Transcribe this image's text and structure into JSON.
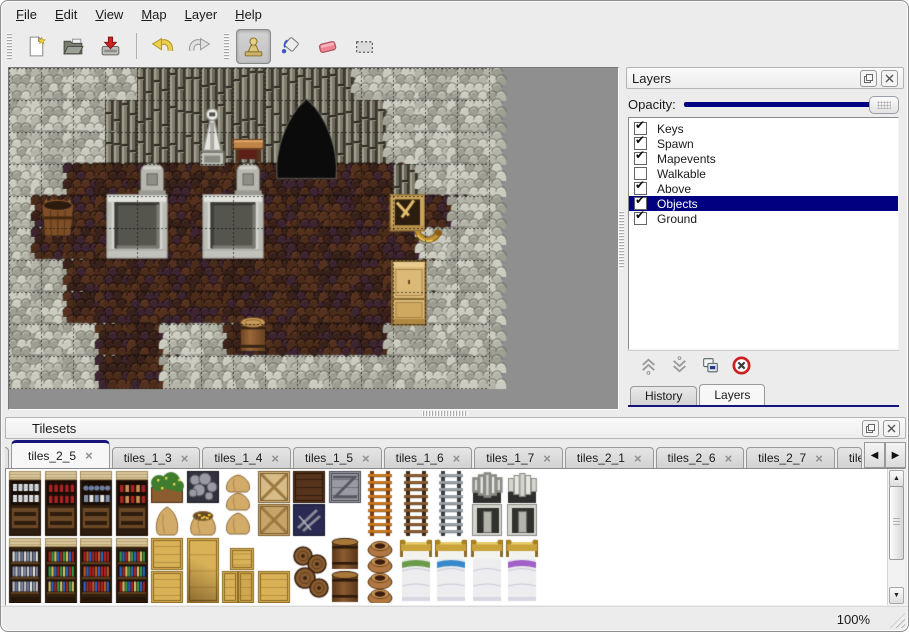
{
  "colors": {
    "accent": "#000080",
    "selection": "#000080",
    "tab_line": "#14147a"
  },
  "menu": {
    "items": [
      {
        "label": "File"
      },
      {
        "label": "Edit"
      },
      {
        "label": "View"
      },
      {
        "label": "Map"
      },
      {
        "label": "Layer"
      },
      {
        "label": "Help"
      }
    ]
  },
  "toolbar": {
    "buttons": [
      {
        "type": "handle"
      },
      {
        "type": "button",
        "name": "new-map-button",
        "icon": "new-file-icon"
      },
      {
        "type": "button",
        "name": "open-button",
        "icon": "open-folder-icon"
      },
      {
        "type": "button",
        "name": "save-button",
        "icon": "save-icon"
      },
      {
        "type": "separator"
      },
      {
        "type": "button",
        "name": "undo-button",
        "icon": "undo-icon"
      },
      {
        "type": "button",
        "name": "redo-button",
        "icon": "redo-icon"
      },
      {
        "type": "handle"
      },
      {
        "type": "button",
        "name": "stamp-tool-button",
        "icon": "stamp-icon",
        "active": true
      },
      {
        "type": "button",
        "name": "fill-tool-button",
        "icon": "fill-icon"
      },
      {
        "type": "button",
        "name": "eraser-tool-button",
        "icon": "eraser-icon"
      },
      {
        "type": "button",
        "name": "select-tool-button",
        "icon": "select-icon"
      }
    ]
  },
  "layers_panel": {
    "title": "Layers",
    "float_glyph": "float-icon",
    "close_glyph": "close-icon",
    "opacity_label": "Opacity:",
    "opacity_percent": 100,
    "check_glyph": "✔",
    "layers": [
      {
        "name": "Keys",
        "checked": true,
        "selected": false
      },
      {
        "name": "Spawn",
        "checked": true,
        "selected": false
      },
      {
        "name": "Mapevents",
        "checked": true,
        "selected": false
      },
      {
        "name": "Walkable",
        "checked": false,
        "selected": false
      },
      {
        "name": "Above",
        "checked": true,
        "selected": false
      },
      {
        "name": "Objects",
        "checked": true,
        "selected": true
      },
      {
        "name": "Ground",
        "checked": true,
        "selected": false
      }
    ],
    "buttons": [
      {
        "name": "raise-layer-button",
        "icon": "chevrons-up-icon"
      },
      {
        "name": "lower-layer-button",
        "icon": "chevrons-down-icon"
      },
      {
        "name": "duplicate-layer-button",
        "icon": "copy-icon"
      },
      {
        "name": "delete-layer-button",
        "icon": "delete-icon"
      }
    ],
    "tabs": [
      {
        "label": "History",
        "active": false
      },
      {
        "label": "Layers",
        "active": true
      }
    ]
  },
  "tilesets_panel": {
    "title": "Tilesets",
    "tabs": [
      {
        "label": "tiles_2_5",
        "active": true
      },
      {
        "label": "tiles_1_3"
      },
      {
        "label": "tiles_1_4"
      },
      {
        "label": "tiles_1_5"
      },
      {
        "label": "tiles_1_6"
      },
      {
        "label": "tiles_1_7"
      },
      {
        "label": "tiles_2_1"
      },
      {
        "label": "tiles_2_6"
      },
      {
        "label": "tiles_2_7"
      },
      {
        "label": "tiles_",
        "truncated": true
      }
    ],
    "tab_close_glyph": "×",
    "scroll_left_glyph": "◀",
    "scroll_right_glyph": "▶",
    "scroll_up_glyph": "▲",
    "scroll_down_glyph": "▼"
  },
  "statusbar": {
    "zoom": "100%"
  },
  "map_data": {
    "tile_size": 32,
    "legend": {
      "W": "light-rock-wall",
      "D": "dark-rib-wall",
      "F": "dirt-floor"
    },
    "grid": [
      "WWWWDDDDDDDWWWW",
      "WWWDDDDDDDDDWWW",
      "WWWDDDDDDDDDWWW",
      "WWFFFFFFFFFFDWW",
      "WFFFFFFFFFFFFFW",
      "WFFFFFFFFFFFFWW",
      "WWFFFFFFFFFFFWW",
      "WWFFFFFFFFFFFWW",
      "WWWFFWWFFFFFWWW",
      "WWWFFWWWWWWWWWW"
    ],
    "objects": [
      {
        "type": "cave-entrance",
        "x": 8.15,
        "y": 0.9,
        "w": 2.3,
        "h": 2.55
      },
      {
        "type": "statue",
        "x": 5.85,
        "y": 1.2,
        "w": 1.0,
        "h": 1.85
      },
      {
        "type": "table",
        "x": 6.95,
        "y": 2.1,
        "w": 1.05,
        "h": 0.9
      },
      {
        "type": "gravestone",
        "x": 4.05,
        "y": 2.95,
        "w": 0.85,
        "h": 1.0
      },
      {
        "type": "gravestone",
        "x": 7.05,
        "y": 2.95,
        "w": 0.85,
        "h": 1.0
      },
      {
        "type": "tomb-slab",
        "x": 3.05,
        "y": 3.95,
        "w": 1.9,
        "h": 2.0
      },
      {
        "type": "tomb-slab",
        "x": 6.05,
        "y": 3.95,
        "w": 1.9,
        "h": 2.0
      },
      {
        "type": "barrel-planter",
        "x": 0.95,
        "y": 3.95,
        "w": 1.15,
        "h": 1.35
      },
      {
        "type": "crate-broken",
        "x": 11.9,
        "y": 3.95,
        "w": 1.1,
        "h": 1.15
      },
      {
        "type": "horn",
        "x": 12.55,
        "y": 4.55,
        "w": 1.1,
        "h": 1.05
      },
      {
        "type": "wardrobe",
        "x": 11.95,
        "y": 6.0,
        "w": 1.1,
        "h": 2.05
      },
      {
        "type": "barrel",
        "x": 7.15,
        "y": 7.7,
        "w": 0.95,
        "h": 1.2
      }
    ]
  },
  "tileset_data": {
    "tile_size": 32,
    "col_pitch": 35.5,
    "row_y": [
      2,
      35,
      69,
      102
    ],
    "origin_x": 3,
    "items": [
      {
        "t": "shelf-dishes",
        "c": 0,
        "r": 0,
        "rs": 2
      },
      {
        "t": "shelf-bottles",
        "c": 1,
        "r": 0,
        "rs": 2
      },
      {
        "t": "shelf-pots",
        "c": 2,
        "r": 0,
        "rs": 2
      },
      {
        "t": "shelf-jars",
        "c": 3,
        "r": 0,
        "rs": 2
      },
      {
        "t": "plant-box",
        "c": 4,
        "r": 0
      },
      {
        "t": "sack",
        "c": 4,
        "r": 1
      },
      {
        "t": "stone-box",
        "c": 5,
        "r": 0
      },
      {
        "t": "open-sack",
        "c": 5,
        "r": 1
      },
      {
        "t": "sack-pile",
        "c": 6,
        "r": 0,
        "rs": 2
      },
      {
        "t": "crate-x-light",
        "c": 7,
        "r": 0
      },
      {
        "t": "crate-x-dark",
        "c": 7,
        "r": 1
      },
      {
        "t": "crate-dark",
        "c": 8,
        "r": 0
      },
      {
        "t": "crate-blue",
        "c": 8,
        "r": 1
      },
      {
        "t": "crate-metal",
        "c": 9,
        "r": 0
      },
      {
        "t": "ladder-orange",
        "c": 10,
        "r": 0,
        "rs": 2
      },
      {
        "t": "ladder-brown",
        "c": 11,
        "r": 0,
        "rs": 2
      },
      {
        "t": "ladder-steel",
        "c": 12,
        "r": 0,
        "rs": 2
      },
      {
        "t": "arch-stone",
        "c": 13,
        "r": 0
      },
      {
        "t": "door-stone",
        "c": 13,
        "r": 1
      },
      {
        "t": "arch-stone",
        "c": 14,
        "r": 0
      },
      {
        "t": "door-stone",
        "c": 14,
        "r": 1
      },
      {
        "t": "shelf-books-a",
        "c": 0,
        "r": 2,
        "rs": 2
      },
      {
        "t": "shelf-books-b",
        "c": 1,
        "r": 2,
        "rs": 2
      },
      {
        "t": "shelf-books-c",
        "c": 2,
        "r": 2,
        "rs": 2
      },
      {
        "t": "shelf-books-d",
        "c": 3,
        "r": 2,
        "rs": 2
      },
      {
        "t": "crate-tan",
        "c": 4,
        "r": 2
      },
      {
        "t": "crate-tan",
        "c": 4,
        "r": 3
      },
      {
        "t": "crate-tan-big",
        "c": 5,
        "r": 2,
        "rs": 2
      },
      {
        "t": "crate-tan-high",
        "c": 6,
        "r": 2
      },
      {
        "t": "crate-tan-pair",
        "c": 6,
        "r": 3
      },
      {
        "t": "crate-tan",
        "c": 7,
        "r": 3
      },
      {
        "t": "barrel-pile",
        "c": 8,
        "r": 2,
        "rs": 2
      },
      {
        "t": "barrel-stack",
        "c": 9,
        "r": 2,
        "rs": 2
      },
      {
        "t": "pot-column",
        "c": 10,
        "r": 2,
        "rs": 2
      },
      {
        "t": "bed-green",
        "c": 11,
        "r": 2,
        "rs": 2
      },
      {
        "t": "bed-blue",
        "c": 12,
        "r": 2,
        "rs": 2
      },
      {
        "t": "bed-plain",
        "c": 13,
        "r": 2,
        "rs": 2
      },
      {
        "t": "bed-purple",
        "c": 14,
        "r": 2,
        "rs": 2
      }
    ]
  }
}
